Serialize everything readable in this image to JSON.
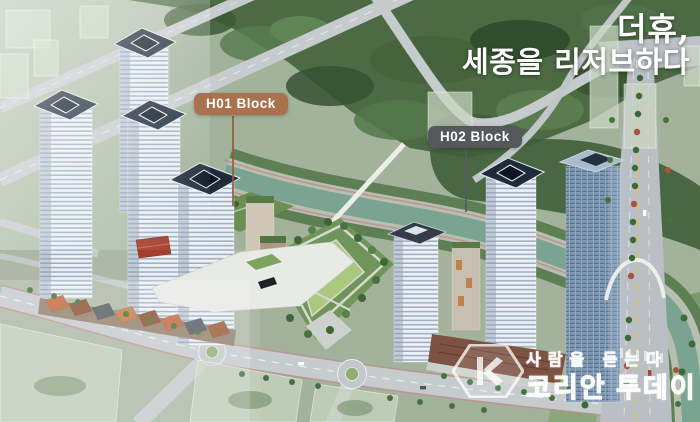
{
  "scene": {
    "description": "aerial architectural rendering of apartment complex blocks beside a stream and forest",
    "title": {
      "line1": "더휴,",
      "line2": "세종을 리저브하다"
    },
    "block_labels": [
      {
        "id": "H01",
        "label": "H01 Block",
        "color": "#a9714e"
      },
      {
        "id": "H02",
        "label": "H02 Block",
        "color": "#55595c"
      }
    ],
    "watermark": {
      "logo_icon": "hexagon-k-icon",
      "slogan": "사람을 듣는다",
      "name": "코리안 투데이"
    },
    "colors": {
      "forest": "#4c6a44",
      "river": "#7aa391",
      "road": "#c6cbce",
      "lawn": "#abc97e",
      "tower_roof": "#1d2b3b",
      "ghost_building": "#c9d6c2",
      "bike_lane": "#c08d90"
    }
  }
}
